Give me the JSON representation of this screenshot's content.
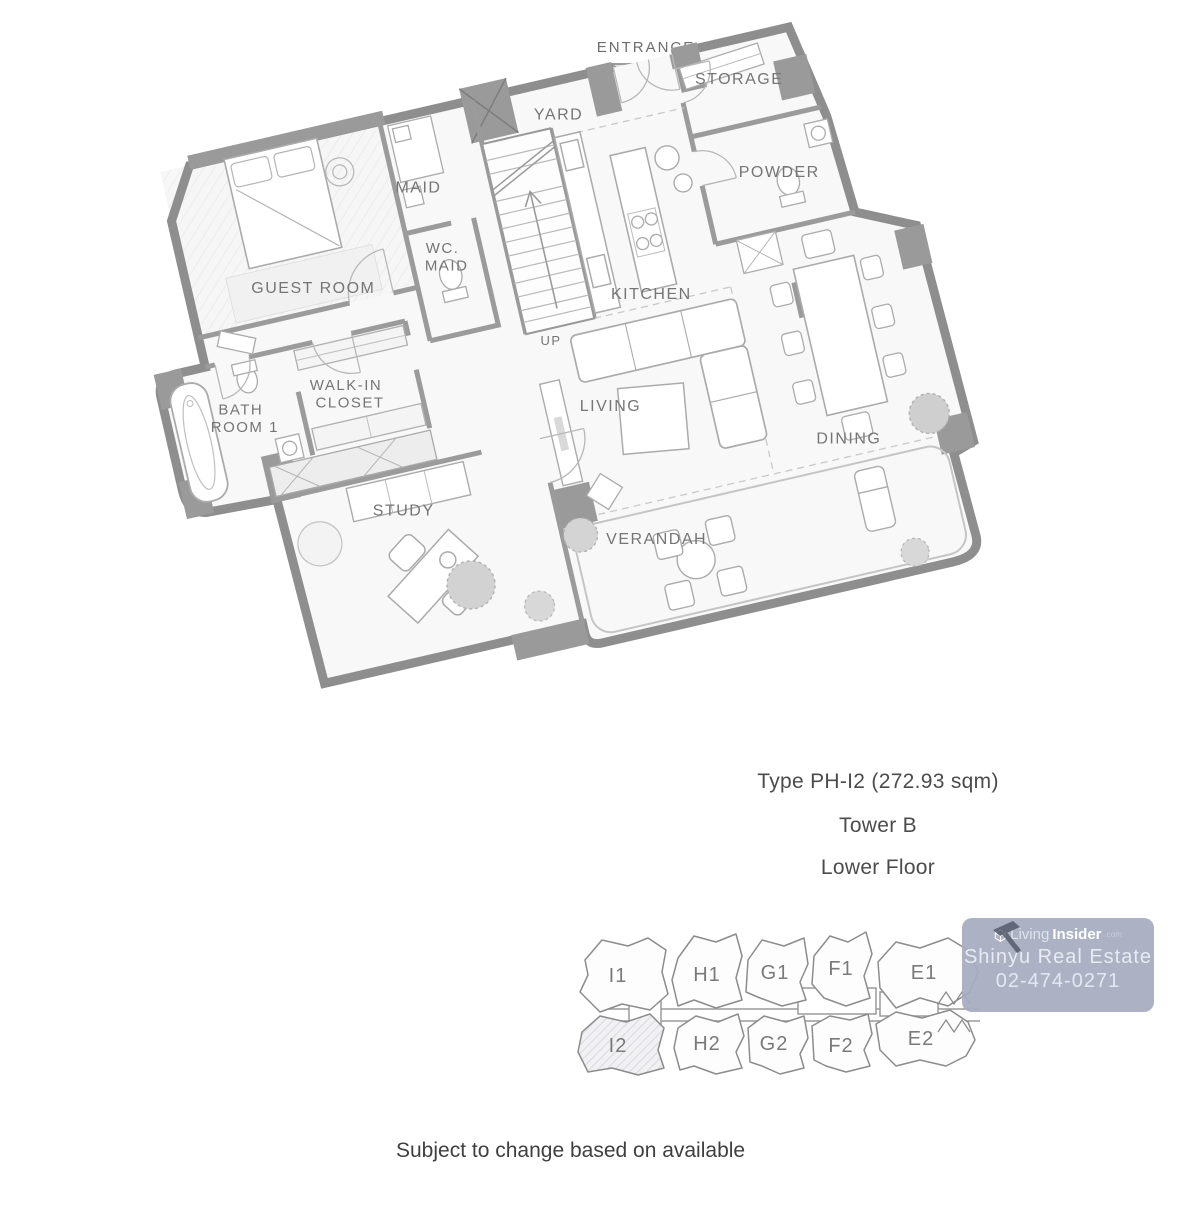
{
  "colors": {
    "wall_gray": "#8e8e8e",
    "column_gray": "#9a9a9a",
    "room_label_gray": "#757575",
    "watermark_badge": "#a6acbf",
    "watermark_text": "#eef1f8",
    "keyplan_highlight_hatch": "#d9d9de"
  },
  "floorplan": {
    "entrance_label": "ENTRANCE",
    "up_label": "UP",
    "rooms": [
      {
        "id": "guest-room",
        "label": "GUEST ROOM"
      },
      {
        "id": "maid",
        "label": "MAID"
      },
      {
        "id": "wc-maid",
        "lines": [
          "WC.",
          "MAID"
        ]
      },
      {
        "id": "yard",
        "label": "YARD"
      },
      {
        "id": "storage",
        "label": "STORAGE"
      },
      {
        "id": "powder",
        "label": "POWDER"
      },
      {
        "id": "kitchen",
        "label": "KITCHEN"
      },
      {
        "id": "bath-room-1",
        "lines": [
          "BATH",
          "ROOM 1"
        ]
      },
      {
        "id": "walk-in-closet",
        "lines": [
          "WALK-IN",
          "CLOSET"
        ]
      },
      {
        "id": "living",
        "label": "LIVING"
      },
      {
        "id": "dining",
        "label": "DINING"
      },
      {
        "id": "study",
        "label": "STUDY"
      },
      {
        "id": "verandah",
        "label": "VERANDAH"
      }
    ]
  },
  "details": {
    "type_line": "Type PH-I2 (272.93 sqm)",
    "tower_line": "Tower B",
    "floor_line": "Lower Floor"
  },
  "keyplan": {
    "highlighted_unit": "I2",
    "top_row": [
      "I1",
      "H1",
      "G1",
      "F1",
      "E1"
    ],
    "bottom_row": [
      "I2",
      "H2",
      "G2",
      "F2",
      "E2"
    ]
  },
  "watermark": {
    "brand_prefix": "Living",
    "brand_name": "Insider",
    "brand_tld": ".com",
    "agency": "Shinyu Real Estate",
    "phone": "02-474-0271"
  },
  "footer": {
    "disclaimer": "Subject to change based on available"
  }
}
